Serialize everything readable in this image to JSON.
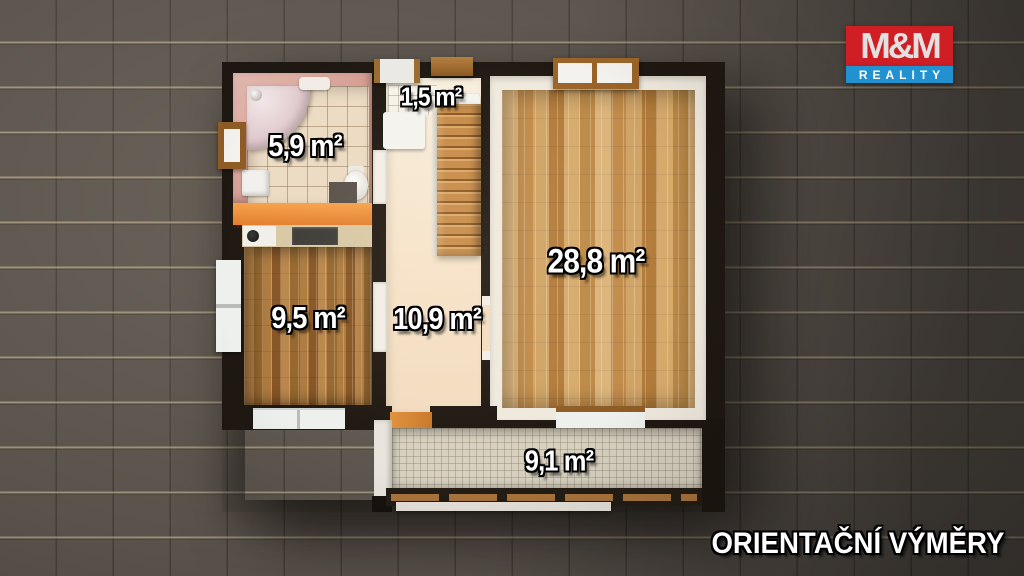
{
  "branding": {
    "logo_line1": "M&M",
    "logo_line2": "REALITY",
    "logo_red": "#d01e25",
    "logo_blue": "#2191cf"
  },
  "footer": {
    "disclaimer": "ORIENTAČNÍ VÝMĚRY"
  },
  "floorplan": {
    "wall_color": "#1f1812",
    "rooms": [
      {
        "id": "bathroom",
        "area_label": "5,9 m²"
      },
      {
        "id": "wc",
        "area_label": "1,5 m²"
      },
      {
        "id": "living-room",
        "area_label": "28,8 m²"
      },
      {
        "id": "kitchen",
        "area_label": "9,5 m²"
      },
      {
        "id": "hallway",
        "area_label": "10,9 m²"
      },
      {
        "id": "balcony",
        "area_label": "9,1 m²"
      }
    ]
  }
}
